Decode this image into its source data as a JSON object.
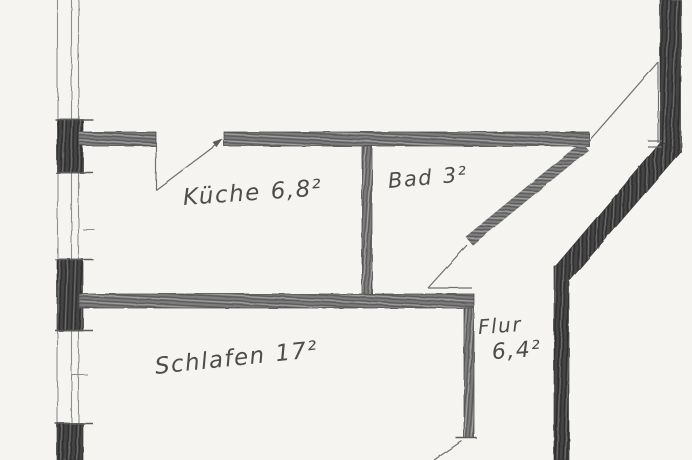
{
  "floorplan": {
    "rooms": [
      {
        "name": "Küche",
        "area": "6,8²"
      },
      {
        "name": "Bad",
        "area": "3²"
      },
      {
        "name": "Flur",
        "area": "6,4²"
      },
      {
        "name": "Schlafen",
        "area": "17²"
      }
    ],
    "colors": {
      "paper": "#f7f6f3",
      "pencil_dark": "#454545",
      "pencil_mid": "#7d7d7d",
      "pencil_light": "#a5a5a5",
      "handwriting": "#4d4d4d"
    }
  }
}
